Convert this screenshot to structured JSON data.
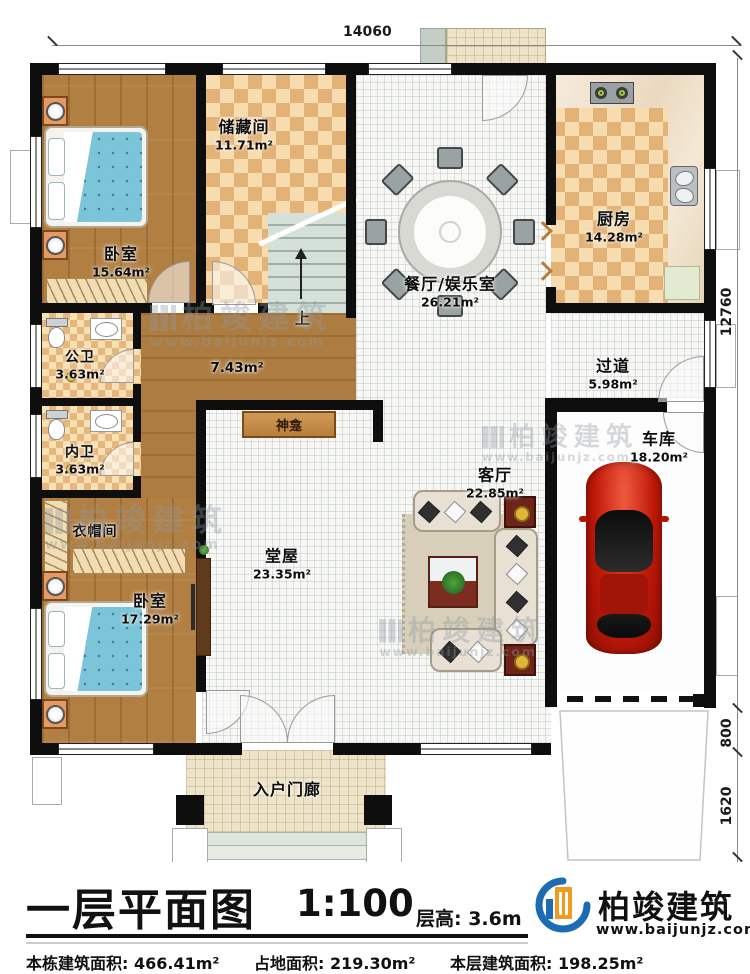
{
  "dimensions": {
    "top": "14060",
    "right": [
      "12760",
      "800",
      "1620"
    ]
  },
  "rooms": [
    {
      "name": "卧室",
      "area": "15.64m²"
    },
    {
      "name": "储藏间",
      "area": "11.71m²"
    },
    {
      "name": "餐厅/娱乐室",
      "area": "26.21m²"
    },
    {
      "name": "厨房",
      "area": "14.28m²"
    },
    {
      "name": "公卫",
      "area": "3.63m²"
    },
    {
      "name": "内卫",
      "area": "3.63m²"
    },
    {
      "name": "",
      "area": "7.43m²"
    },
    {
      "name": "过道",
      "area": "5.98m²"
    },
    {
      "name": "衣帽间",
      "area": ""
    },
    {
      "name": "卧室",
      "area": "17.29m²"
    },
    {
      "name": "堂屋",
      "area": "23.35m²"
    },
    {
      "name": "客厅",
      "area": "22.85m²"
    },
    {
      "name": "车库",
      "area": "18.20m²"
    },
    {
      "name": "入户门廊",
      "area": ""
    }
  ],
  "plan_labels": {
    "stairs_up": "上",
    "shrine": "神龛"
  },
  "footer": {
    "title": "一层平面图",
    "scale": "1:100",
    "floor_height": "层高: 3.6m",
    "stats": [
      {
        "label": "本栋建筑面积:",
        "value": "466.41m²"
      },
      {
        "label": "占地面积:",
        "value": "219.30m²"
      },
      {
        "label": "本层建筑面积:",
        "value": "198.25m²"
      }
    ]
  },
  "brand": {
    "name": "柏竣建筑",
    "url": "www.baijunjz.com"
  },
  "watermark": {
    "name": "柏竣建筑",
    "url": "www.baijunjz.com"
  },
  "colors": {
    "wall": "#0e0e0e",
    "wood_floor": "#b17f42",
    "checker_dark": "#e2b277",
    "checker_light": "#f6dcae",
    "bed_blue": "#7cc4d8",
    "car_red": "#c01808",
    "brand_blue": "#1b6cb3",
    "brand_orange": "#f29a1e"
  }
}
